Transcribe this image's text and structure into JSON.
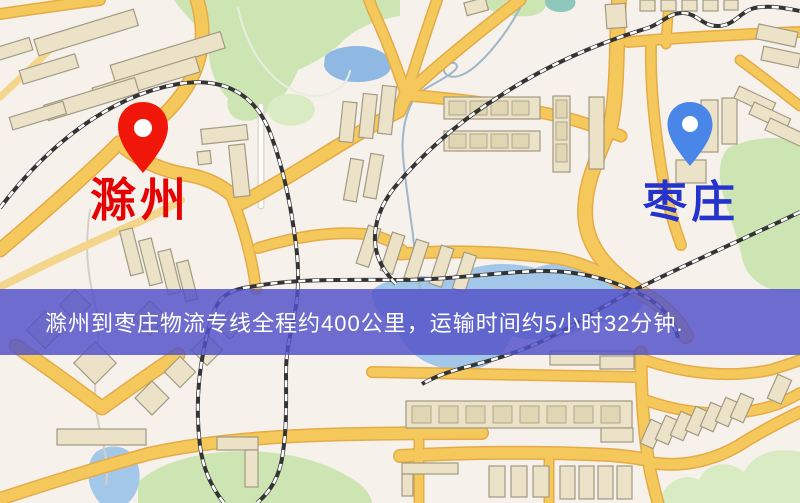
{
  "map": {
    "origin": {
      "name": "滁州",
      "label_color": "#e60202",
      "pin_color": "#f0170a"
    },
    "destination": {
      "name": "枣庄",
      "label_color": "#2433cc",
      "pin_color": "#4a86e8"
    },
    "info_banner": {
      "text": "滁州到枣庄物流专线全程约400公里，运输时间约5小时32分钟.",
      "text_color": "#ffffff",
      "background": "rgba(82,82,201,0.83)"
    },
    "route": {
      "distance_text": "约400公里",
      "duration_text": "约5小时32分钟"
    },
    "legend_colors": {
      "background": "#f6f1ea",
      "major_road": "#f5c85c",
      "minor_road": "#fdfdfa",
      "railway": "#343434",
      "water": "#a3c7e8",
      "park": "#cde5b3",
      "building": "#ebe2c8"
    }
  }
}
